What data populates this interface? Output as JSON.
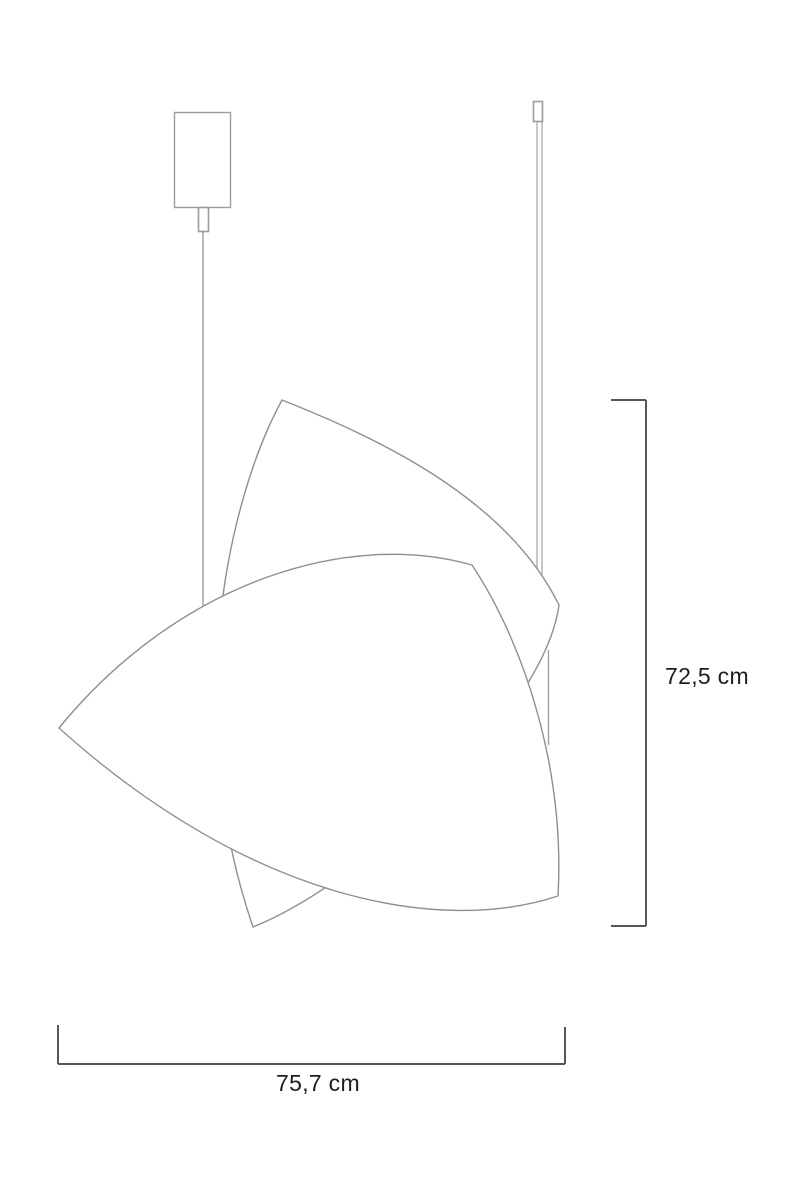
{
  "drawing": {
    "title": "pendant-lamp-dimension-drawing",
    "labels": {
      "height": "72,5 cm",
      "width": "75,7 cm"
    },
    "colors": {
      "hardware": "#9c9c9c",
      "shade": "#8f8f8f",
      "dimension": "#57575a",
      "text": "#1d1d1b",
      "background": "#ffffff"
    },
    "parts": [
      "ceiling-canopy",
      "strain-relief",
      "power-cable",
      "rod-connector",
      "suspension-rod",
      "shade-back-leaf",
      "shade-front-leaf"
    ]
  }
}
